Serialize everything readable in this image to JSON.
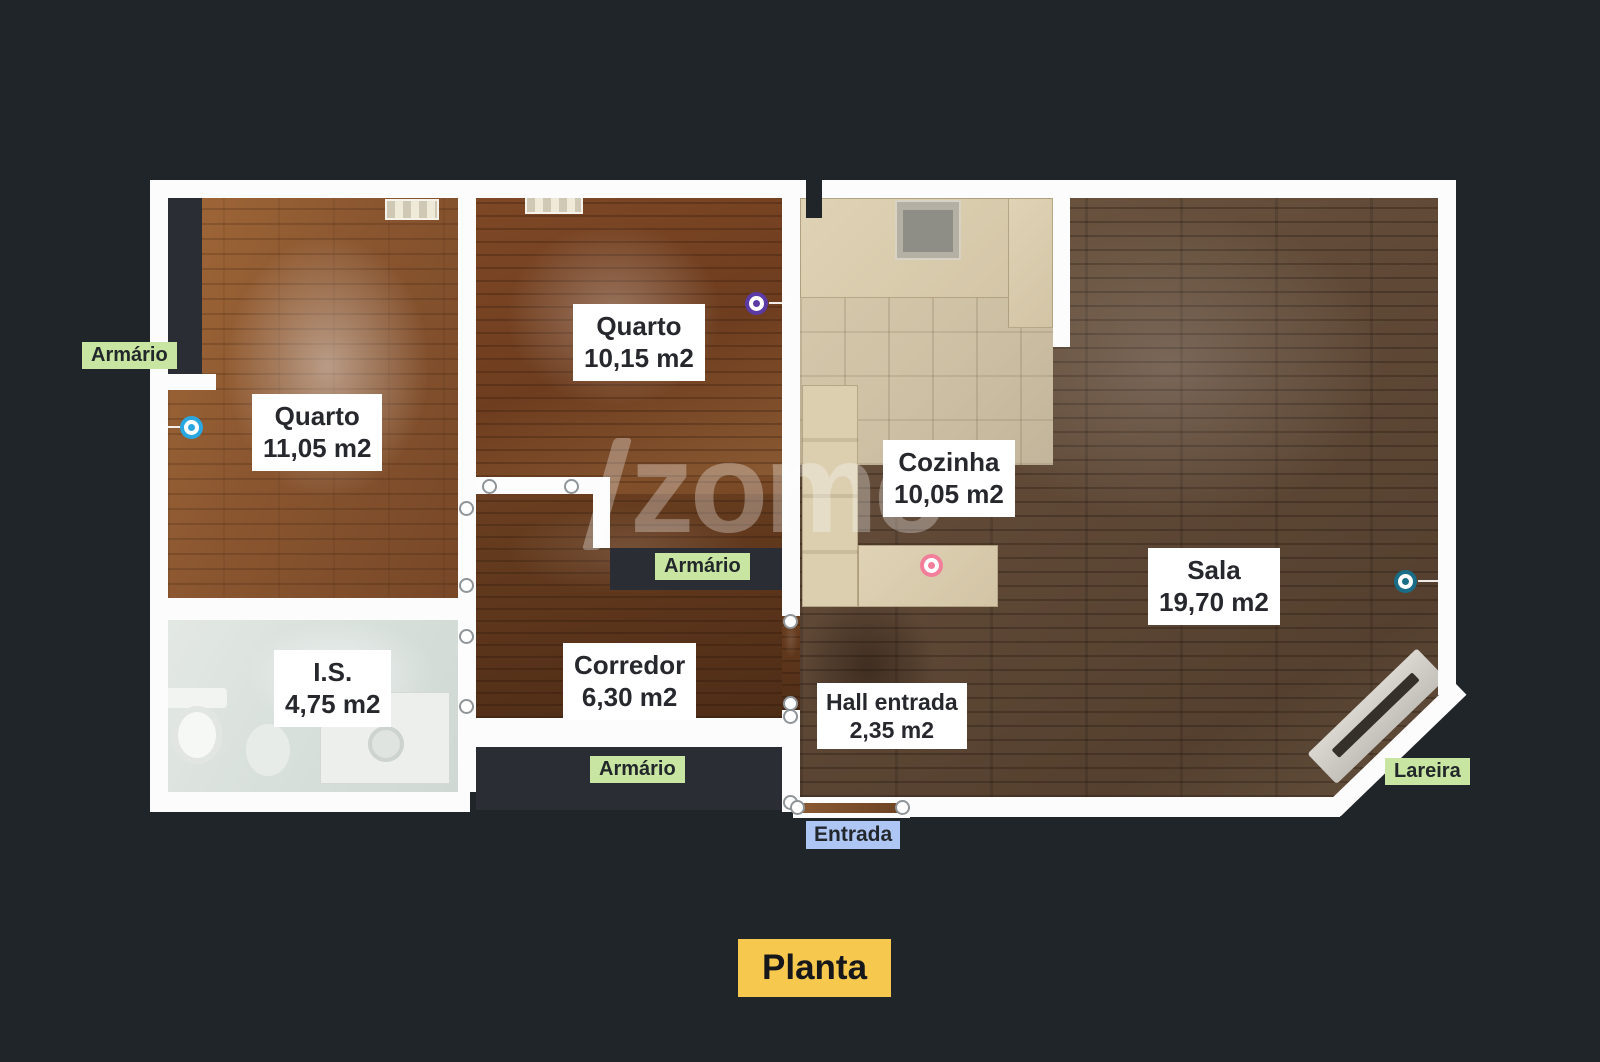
{
  "page": {
    "title": "Planta"
  },
  "watermark": {
    "text": "zome",
    "registered": "®"
  },
  "rooms": [
    {
      "name": "Quarto",
      "area": "11,05 m2"
    },
    {
      "name": "Quarto",
      "area": "10,15 m2"
    },
    {
      "name": "Cozinha",
      "area": "10,05 m2"
    },
    {
      "name": "Sala",
      "area": "19,70 m2"
    },
    {
      "name": "I.S.",
      "area": "4,75 m2"
    },
    {
      "name": "Corredor",
      "area": "6,30 m2"
    },
    {
      "name": "Hall entrada",
      "area": "2,35 m2"
    }
  ],
  "features": {
    "armario": "Armário",
    "lareira": "Lareira",
    "entrada": "Entrada"
  },
  "markers": [
    {
      "room": "Quarto 11,05 m2",
      "color": "#2aa7e0"
    },
    {
      "room": "Quarto 10,15 m2",
      "color": "#5b3aa6"
    },
    {
      "room": "Cozinha 10,05 m2",
      "color": "#f27e9b"
    },
    {
      "room": "Sala 19,70 m2",
      "color": "#1a6d86"
    }
  ],
  "colors": {
    "background": "#20252a",
    "wall": "#fcfcfc",
    "label_green": "#c8e6a1",
    "label_blue": "#aec6f3",
    "label_yellow": "#f7c84e",
    "label_text": "#27282d"
  }
}
